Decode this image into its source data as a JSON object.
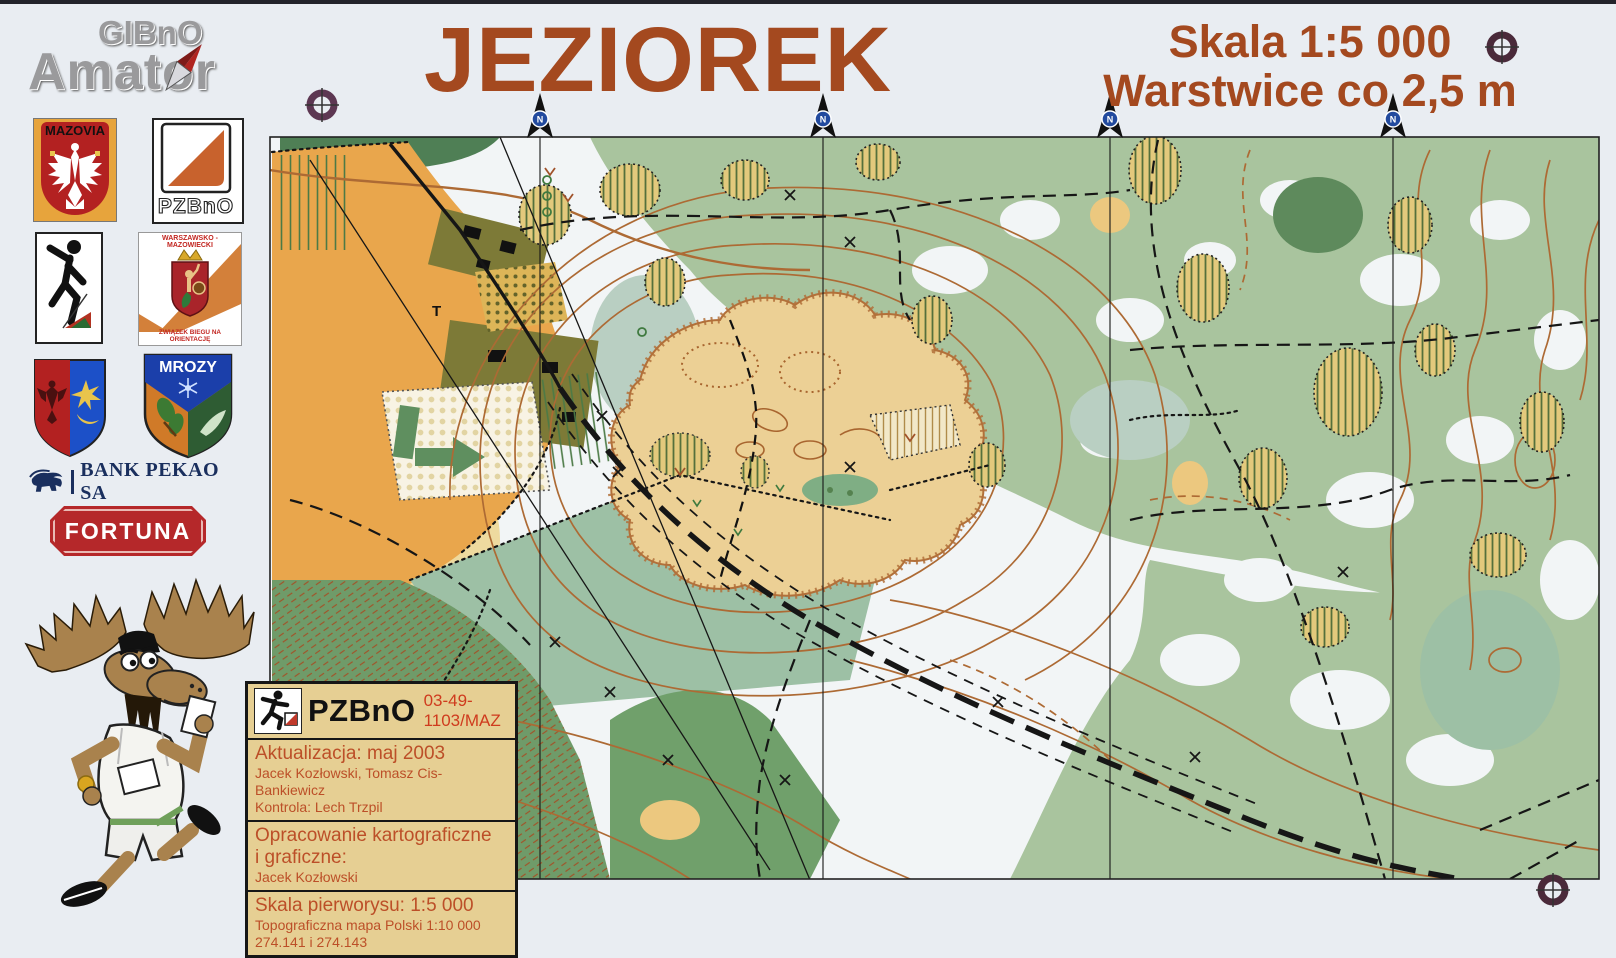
{
  "page": {
    "background": "#e9edf2",
    "accent_brown": "#a4491f"
  },
  "header": {
    "title": "JEZIOREK",
    "scale": "Skala 1:5 000",
    "contours": "Warstwice co 2,5 m"
  },
  "sidebar": {
    "gibno": {
      "line1": "GIBnO",
      "line2": "Amator"
    },
    "mazovia": {
      "label": "MAZOVIA"
    },
    "pzbno_flag": {
      "label": "PZBnO"
    },
    "wm_zbno": {
      "top": "WARSZAWSKO - MAZOWIECKI",
      "bottom": "ZWIĄZEK BIEGU NA ORIENTACJĘ"
    },
    "mrozy": {
      "label": "MROZY"
    },
    "bank": {
      "label": "BANK PEKAO SA"
    },
    "fortuna": {
      "label": "FORTUNA"
    }
  },
  "map": {
    "north_label": "N",
    "t_label": "T",
    "colors": {
      "open_orange": "#e9a64c",
      "rough_yellow": "#eeda9f",
      "forest_white": "#f2f5f6",
      "vegetation_green": "#a9c49e",
      "field_green": "#9dc0a5",
      "dark_green": "#6f9b69",
      "settlement_olive": "#7d7a37",
      "sand": "#ecd095",
      "contour_brown": "#ad6a34"
    }
  },
  "info_box": {
    "org": "PZBnO",
    "code": "03-49-1103/MAZ",
    "update": {
      "line1": "Aktualizacja: maj 2003",
      "line2": "Jacek Kozłowski, Tomasz Cis-Bankiewicz",
      "line3": "Kontrola: Lech Trzpil"
    },
    "cartography": {
      "line1": "Opracowanie kartograficzne",
      "line2": "i graficzne:",
      "line3": "Jacek Kozłowski"
    },
    "source": {
      "line1": "Skala pierworysu: 1:5 000",
      "line2": "Topograficzna mapa Polski 1:10 000",
      "line3": "274.141 i 274.143"
    }
  }
}
